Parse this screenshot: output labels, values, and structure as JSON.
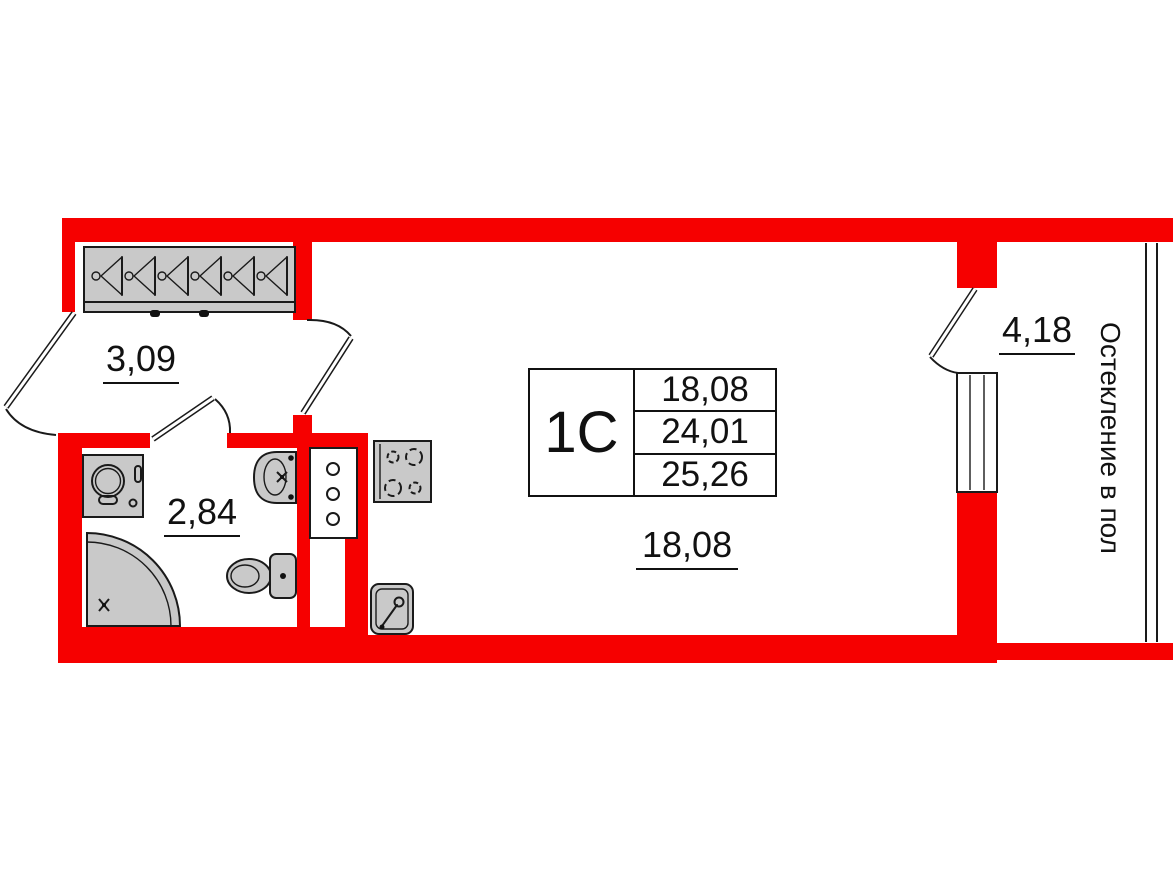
{
  "unit": {
    "type_label": "1С"
  },
  "area_table": {
    "rows": [
      "18,08",
      "24,01",
      "25,26"
    ]
  },
  "room_labels": {
    "hallway": "3,09",
    "bathroom": "2,84",
    "living_room": "18,08",
    "balcony": "4,18"
  },
  "annotations": {
    "glazing_note": "Остекление в пол"
  },
  "colors": {
    "wall_red": "#f60000",
    "fixture_gray": "#c9c9c9",
    "line_black": "#1a1a1a"
  }
}
